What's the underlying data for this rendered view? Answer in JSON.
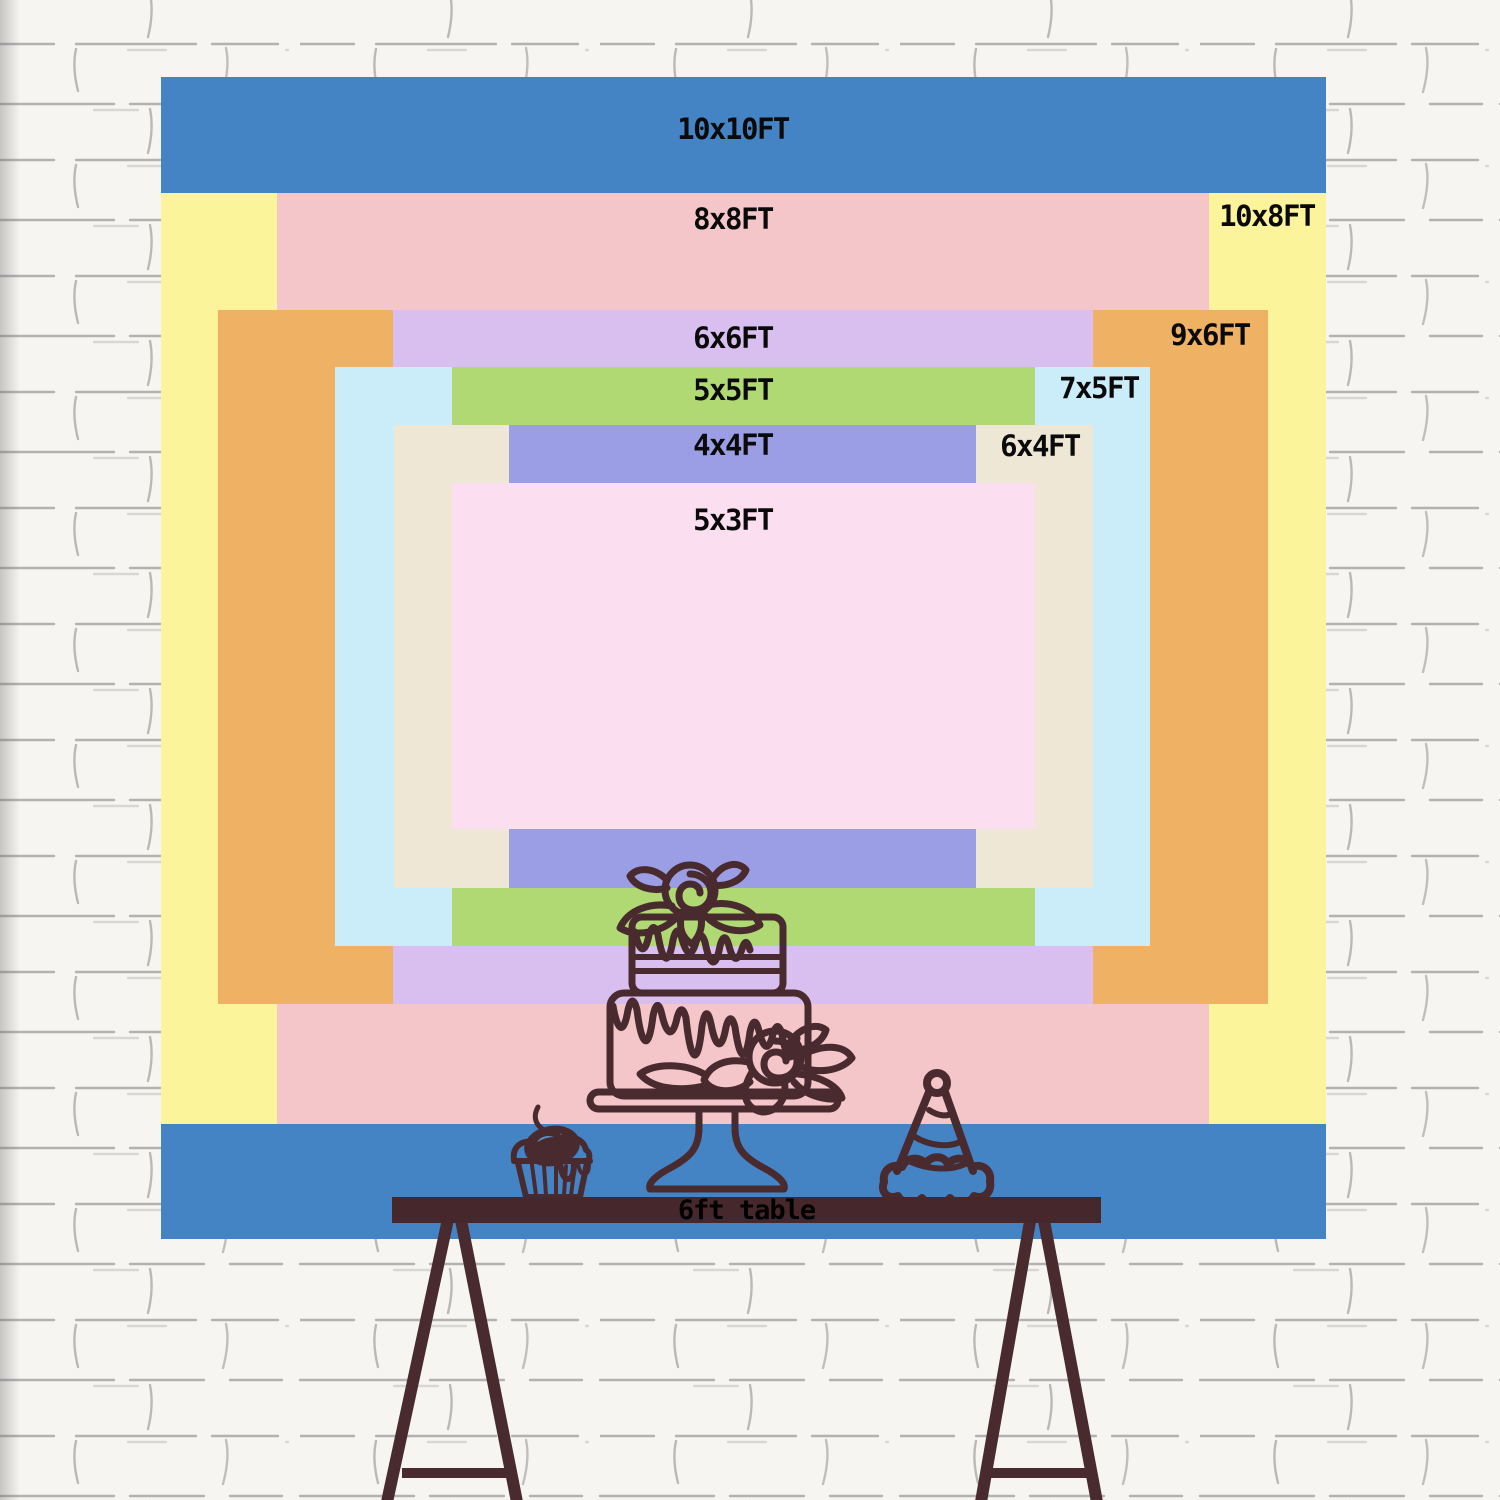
{
  "colors": {
    "wall_bg": "#f6f5f2",
    "mortar": "#8b8987",
    "outline": "#492b2f",
    "table": "#46282c",
    "label_text": "#0a0a0a"
  },
  "chart": {
    "description": "Nested backdrop size comparison rectangles on brick wall",
    "sizes": [
      {
        "id": "10x10",
        "label": "10x10FT",
        "color": "#4484C5",
        "rect": {
          "x": 161,
          "y": 77,
          "w": 1165,
          "h": 1162
        },
        "label_pos": {
          "x": 733,
          "y": 129
        }
      },
      {
        "id": "10x8",
        "label": "10x8FT",
        "color": "#FCF49B",
        "rect": {
          "x": 161,
          "y": 193,
          "w": 1165,
          "h": 931
        },
        "label_pos": {
          "x": 1267,
          "y": 216
        }
      },
      {
        "id": "8x8",
        "label": "8x8FT",
        "color": "#F5C6C9",
        "rect": {
          "x": 277,
          "y": 193,
          "w": 932,
          "h": 931
        },
        "label_pos": {
          "x": 733,
          "y": 219
        }
      },
      {
        "id": "9x6",
        "label": "9x6FT",
        "color": "#EFB164",
        "rect": {
          "x": 218,
          "y": 310,
          "w": 1050,
          "h": 694
        },
        "label_pos": {
          "x": 1210,
          "y": 335
        }
      },
      {
        "id": "6x6",
        "label": "6x6FT",
        "color": "#D9BFEF",
        "rect": {
          "x": 393,
          "y": 310,
          "w": 700,
          "h": 694
        },
        "label_pos": {
          "x": 733,
          "y": 338
        }
      },
      {
        "id": "7x5",
        "label": "7x5FT",
        "color": "#CBEDF9",
        "rect": {
          "x": 335,
          "y": 367,
          "w": 815,
          "h": 579
        },
        "label_pos": {
          "x": 1099,
          "y": 388
        }
      },
      {
        "id": "5x5",
        "label": "5x5FT",
        "color": "#B0D974",
        "rect": {
          "x": 452,
          "y": 367,
          "w": 583,
          "h": 579
        },
        "label_pos": {
          "x": 733,
          "y": 390
        }
      },
      {
        "id": "6x4",
        "label": "6x4FT",
        "color": "#EEE7D6",
        "rect": {
          "x": 394,
          "y": 425,
          "w": 699,
          "h": 463
        },
        "label_pos": {
          "x": 1040,
          "y": 446
        }
      },
      {
        "id": "4x4",
        "label": "4x4FT",
        "color": "#9B9EE5",
        "rect": {
          "x": 509,
          "y": 425,
          "w": 467,
          "h": 463
        },
        "label_pos": {
          "x": 733,
          "y": 445
        }
      },
      {
        "id": "5x3",
        "label": "5x3FT",
        "color": "#FBDEEF",
        "rect": {
          "x": 452,
          "y": 483,
          "w": 583,
          "h": 346
        },
        "label_pos": {
          "x": 733,
          "y": 520
        }
      }
    ]
  },
  "table": {
    "label": "6ft table"
  }
}
